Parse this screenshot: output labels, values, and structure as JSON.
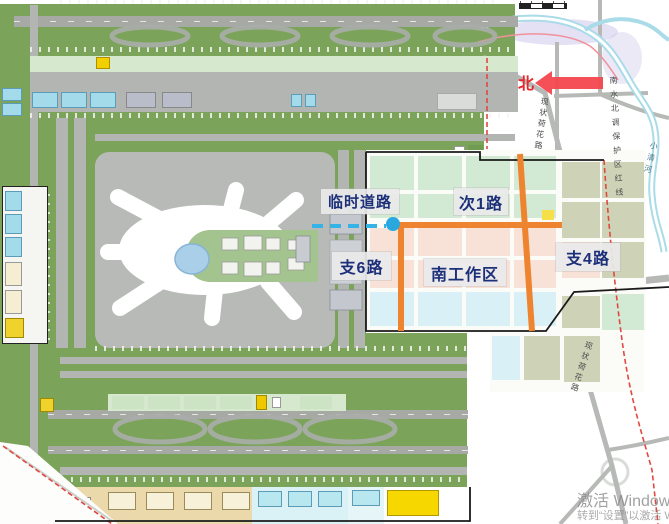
{
  "canvas": {
    "w": 669,
    "h": 524
  },
  "annotations": {
    "north_label": "北",
    "road_labels": [
      {
        "text": "临时道路",
        "x": 321,
        "y": 189,
        "w": 78,
        "h": 25,
        "fs": 15
      },
      {
        "text": "次1路",
        "x": 454,
        "y": 188,
        "w": 54,
        "h": 27,
        "fs": 16
      },
      {
        "text": "支6路",
        "x": 332,
        "y": 252,
        "w": 59,
        "h": 28,
        "fs": 16
      },
      {
        "text": "南工作区",
        "x": 424,
        "y": 259,
        "w": 82,
        "h": 27,
        "fs": 16
      },
      {
        "text": "支4路",
        "x": 556,
        "y": 243,
        "w": 64,
        "h": 28,
        "fs": 16
      }
    ]
  },
  "map_texts": {
    "hehua_road_top": "现状荷花路",
    "hehua_road_bottom": "现状荷花路",
    "water_redline": "南水北调保护区红线",
    "xiaoqing_river": "小清河"
  },
  "watermark": {
    "line1": "激活 Windows",
    "line2": "转到“设置”以激活 Windows。"
  },
  "colors": {
    "field_green": "#7ba35a",
    "orange_road": "#ef8430",
    "temp_road_blue": "#35b2e6",
    "temp_road_dot": "#29a8e0",
    "label_text": "#1c2f79",
    "north_red": "#e8242c",
    "arrow_red": "#f4474f",
    "boundary_black": "#1a1a1a",
    "redline_dash": "#e04840",
    "river_blue": "#9ed8e6"
  },
  "zones": [
    [
      30,
      56,
      488,
      16,
      "#d6e9cf"
    ],
    [
      32,
      92,
      26,
      16,
      "#a3dbea",
      "#5b9cb8"
    ],
    [
      61,
      92,
      26,
      16,
      "#a3dbea",
      "#5b9cb8"
    ],
    [
      90,
      92,
      26,
      16,
      "#a3dbea",
      "#5b9cb8"
    ],
    [
      126,
      92,
      30,
      16,
      "#b9bdc9",
      "#888888"
    ],
    [
      162,
      92,
      30,
      16,
      "#b9bdc9",
      "#888888"
    ],
    [
      291,
      94,
      11,
      13,
      "#a3dbea",
      "#5b9cb8"
    ],
    [
      305,
      94,
      11,
      13,
      "#a3dbea",
      "#5b9cb8"
    ],
    [
      96,
      57,
      14,
      12,
      "#f2d000",
      "#b09000"
    ],
    [
      2,
      88,
      20,
      13,
      "#a3dbea",
      "#5b9cb8"
    ],
    [
      2,
      103,
      20,
      13,
      "#a3dbea",
      "#5b9cb8"
    ],
    [
      2,
      186,
      46,
      158,
      "#f5f5f1",
      "#222222"
    ],
    [
      5,
      191,
      17,
      20,
      "#a3dbea",
      "#5b9cb8"
    ],
    [
      5,
      214,
      17,
      20,
      "#a3dbea",
      "#5b9cb8"
    ],
    [
      5,
      237,
      17,
      20,
      "#a3dbea",
      "#5b9cb8"
    ],
    [
      5,
      262,
      17,
      24,
      "#f5eed3",
      "#999999"
    ],
    [
      5,
      290,
      17,
      24,
      "#f5eed3",
      "#999999"
    ],
    [
      5,
      318,
      19,
      20,
      "#f0d22c",
      "#a08800"
    ],
    [
      437,
      93,
      40,
      17,
      "#d9dcd8",
      "#aaaaaa"
    ],
    [
      454,
      146,
      11,
      11,
      "#ffffff",
      "#999999"
    ],
    [
      468,
      145,
      15,
      12,
      "#6f9c50"
    ],
    [
      366,
      150,
      280,
      183,
      "#fbfbf8"
    ],
    [
      490,
      332,
      154,
      60,
      "#fbfbf8"
    ],
    [
      370,
      156,
      44,
      34,
      "#d2e9d4"
    ],
    [
      418,
      156,
      44,
      34,
      "#d2e9d4"
    ],
    [
      466,
      156,
      44,
      34,
      "#d2e9d4"
    ],
    [
      514,
      156,
      42,
      34,
      "#d2e9d4"
    ],
    [
      370,
      194,
      44,
      24,
      "#d2e9d4"
    ],
    [
      418,
      194,
      44,
      24,
      "#d2e9d4"
    ],
    [
      466,
      194,
      44,
      24,
      "#d2e9d4"
    ],
    [
      514,
      194,
      42,
      24,
      "#d2e9d4"
    ],
    [
      370,
      228,
      44,
      28,
      "#f8e2d8"
    ],
    [
      418,
      228,
      44,
      28,
      "#f8e2d8"
    ],
    [
      466,
      228,
      44,
      28,
      "#f8e2d8"
    ],
    [
      514,
      228,
      42,
      28,
      "#f8e2d8"
    ],
    [
      370,
      260,
      44,
      28,
      "#f8e2d8"
    ],
    [
      418,
      260,
      44,
      28,
      "#f8e2d8"
    ],
    [
      466,
      260,
      44,
      28,
      "#f8e2d8"
    ],
    [
      514,
      260,
      42,
      28,
      "#f8e2d8"
    ],
    [
      370,
      292,
      44,
      34,
      "#d9f1f6"
    ],
    [
      418,
      292,
      44,
      34,
      "#d9f1f6"
    ],
    [
      466,
      292,
      44,
      34,
      "#d9f1f6"
    ],
    [
      514,
      292,
      42,
      34,
      "#d9f1f6"
    ],
    [
      562,
      162,
      38,
      36,
      "#ced3b8"
    ],
    [
      602,
      162,
      42,
      36,
      "#ced3b8"
    ],
    [
      562,
      202,
      38,
      36,
      "#ced3b8"
    ],
    [
      602,
      202,
      42,
      36,
      "#ced3b8"
    ],
    [
      562,
      242,
      38,
      36,
      "#f8e2d8"
    ],
    [
      602,
      242,
      42,
      36,
      "#ced3b8"
    ],
    [
      562,
      296,
      38,
      32,
      "#ced3b8"
    ],
    [
      602,
      294,
      42,
      36,
      "#d2e9d4"
    ],
    [
      492,
      336,
      28,
      44,
      "#d9f1f6"
    ],
    [
      524,
      336,
      36,
      44,
      "#ced3b8"
    ],
    [
      564,
      336,
      36,
      46,
      "#ced3b8"
    ],
    [
      542,
      210,
      12,
      10,
      "#f5e04a"
    ],
    [
      108,
      394,
      238,
      17,
      "#d6e9cf"
    ],
    [
      112,
      396,
      32,
      13,
      "#cce4c4"
    ],
    [
      148,
      396,
      32,
      13,
      "#cce4c4"
    ],
    [
      184,
      396,
      32,
      13,
      "#cce4c4"
    ],
    [
      220,
      396,
      32,
      13,
      "#cce4c4"
    ],
    [
      300,
      396,
      32,
      13,
      "#cce4c4"
    ],
    [
      256,
      395,
      11,
      15,
      "#f0c800",
      "#a08800"
    ],
    [
      272,
      397,
      9,
      11,
      "#ffffff",
      "#999999"
    ],
    [
      40,
      398,
      14,
      14,
      "#f0d22c",
      "#a08800"
    ],
    [
      55,
      487,
      292,
      37,
      "#ecd9ab"
    ],
    [
      108,
      492,
      28,
      18,
      "#f8f1da",
      "#998c5a"
    ],
    [
      146,
      492,
      28,
      18,
      "#f8f1da",
      "#998c5a"
    ],
    [
      184,
      492,
      28,
      18,
      "#f8f1da",
      "#998c5a"
    ],
    [
      222,
      492,
      28,
      18,
      "#f8f1da",
      "#998c5a"
    ],
    [
      252,
      487,
      96,
      37,
      "#daf2f6"
    ],
    [
      258,
      491,
      24,
      16,
      "#b9e7f0",
      "#5b9cb8"
    ],
    [
      288,
      491,
      24,
      16,
      "#b9e7f0",
      "#5b9cb8"
    ],
    [
      318,
      491,
      24,
      16,
      "#b9e7f0",
      "#5b9cb8"
    ],
    [
      348,
      487,
      36,
      37,
      "#e6f5f8"
    ],
    [
      352,
      490,
      28,
      16,
      "#b9e7f0",
      "#5b9cb8"
    ],
    [
      387,
      490,
      52,
      26,
      "#f6d800",
      "#b09a00"
    ],
    [
      80,
      497,
      11,
      13,
      "#ffffff",
      "#888888"
    ]
  ]
}
